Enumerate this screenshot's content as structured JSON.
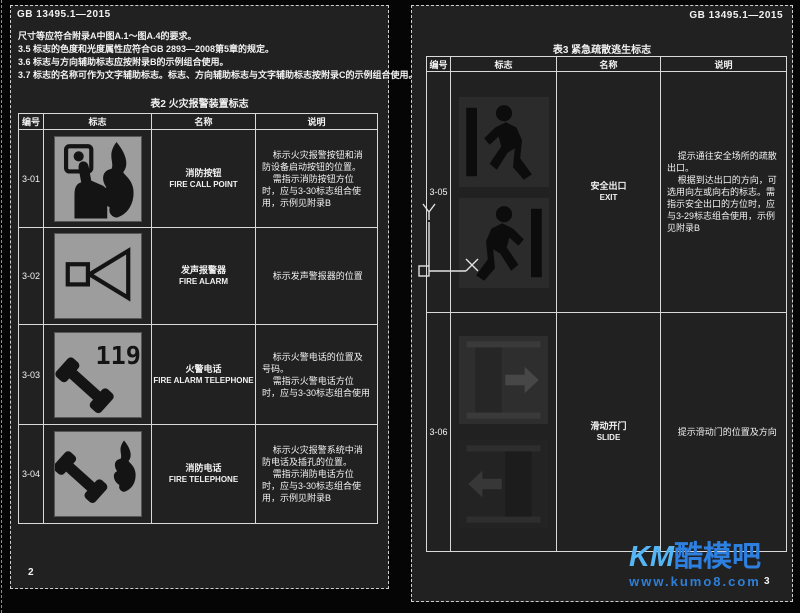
{
  "left_page": {
    "header": "GB 13495.1—2015",
    "page_number": "2",
    "notes": [
      "尺寸等应符合附录A中图A.1～图A.4的要求。",
      "3.5 标志的色度和光度属性应符合GB 2893—2008第5章的规定。",
      "3.6 标志与方向辅助标志应按附录B的示例组合使用。",
      "3.7 标志的名称可作为文字辅助标志。标志、方向辅助标志与文字辅助标志按附录C的示例组合使用。"
    ],
    "table": {
      "title": "表2 火灾报警装置标志",
      "headers": [
        "编号",
        "标志",
        "名称",
        "说明"
      ],
      "rows": [
        {
          "id": "3-01",
          "name_cn": "消防按钮",
          "name_en": "FIRE CALL POINT",
          "icon": "fire-call-point-sign",
          "desc": [
            "标示火灾报警按钮和消防设备启动按钮的位置。",
            "需指示消防按钮方位时，应与3-30标志组合使用，示例见附录B"
          ]
        },
        {
          "id": "3-02",
          "name_cn": "发声报警器",
          "name_en": "FIRE ALARM",
          "icon": "fire-alarm-sign",
          "desc": [
            "标示发声警报器的位置"
          ]
        },
        {
          "id": "3-03",
          "name_cn": "火警电话",
          "name_en": "FIRE ALARM TELEPHONE",
          "icon": "fire-alarm-telephone-sign",
          "badge": "119",
          "desc": [
            "标示火警电话的位置及号码。",
            "需指示火警电话方位时，应与3-30标志组合使用"
          ]
        },
        {
          "id": "3-04",
          "name_cn": "消防电话",
          "name_en": "FIRE TELEPHONE",
          "icon": "fire-telephone-sign",
          "desc": [
            "标示火灾报警系统中消防电话及插孔的位置。",
            "需指示消防电话方位时，应与3-30标志组合使用，示例见附录B"
          ]
        }
      ]
    }
  },
  "right_page": {
    "header": "GB 13495.1—2015",
    "page_number": "3",
    "table": {
      "title": "表3 紧急疏散逃生标志",
      "headers": [
        "编号",
        "标志",
        "名称",
        "说明"
      ],
      "rows": [
        {
          "id": "3-05",
          "name_cn": "安全出口",
          "name_en": "EXIT",
          "icon": "exit-sign",
          "desc": [
            "提示通往安全场所的疏散出口。",
            "根据到达出口的方向，可选用向左或向右的标志。需指示安全出口的方位时，应与3-29标志组合使用，示例见附录B"
          ]
        },
        {
          "id": "3-06",
          "name_cn": "滑动开门",
          "name_en": "SLIDE",
          "icon": "slide-door-sign",
          "desc": [
            "提示滑动门的位置及方向"
          ]
        }
      ]
    }
  },
  "ucs": {
    "x_label": "X",
    "y_label": "Y"
  },
  "watermark": {
    "brand_prefix": "KM",
    "brand_suffix": "酷模吧",
    "url": "www.kumo8.com"
  },
  "colors": {
    "canvas_bg": "#050505",
    "page_bg": "#212121",
    "grid_line": "#d9d9d9",
    "text": "#f2f2f2",
    "sign_grey_bg": "#9d9d9d",
    "sign_dark_bg": "#2b2b2b",
    "pictogram": "#141414",
    "watermark_blue": "#2d7fe0",
    "watermark_light_blue": "#55b6f6"
  }
}
